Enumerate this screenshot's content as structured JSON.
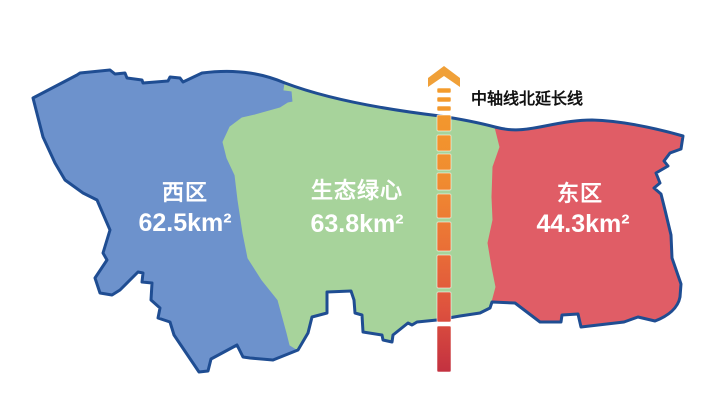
{
  "figure": {
    "background_color": "#FFFFFF",
    "outline_color": "#1F4D92"
  },
  "regions": [
    {
      "name": "西区",
      "area": "62.5km²",
      "fill_color": "#6D92CC"
    },
    {
      "name": "生态绿心",
      "area": "63.8km²",
      "fill_color": "#A7D39B"
    },
    {
      "name": "东区",
      "area": "44.3km²",
      "fill_color": "#E05D66"
    }
  ],
  "region_label_color": "#FFFFFF",
  "axis_line": {
    "label": "中轴线北延长线",
    "label_color": "#111111",
    "arrow_color": "#F0A038",
    "dash_color_top": "#F49C2C",
    "dash_color_upper_mid": "#F08C30",
    "dash_color_mid": "#EA7136",
    "dash_color_lower_mid": "#DE523E",
    "dash_color_bottom": "#C33140"
  }
}
